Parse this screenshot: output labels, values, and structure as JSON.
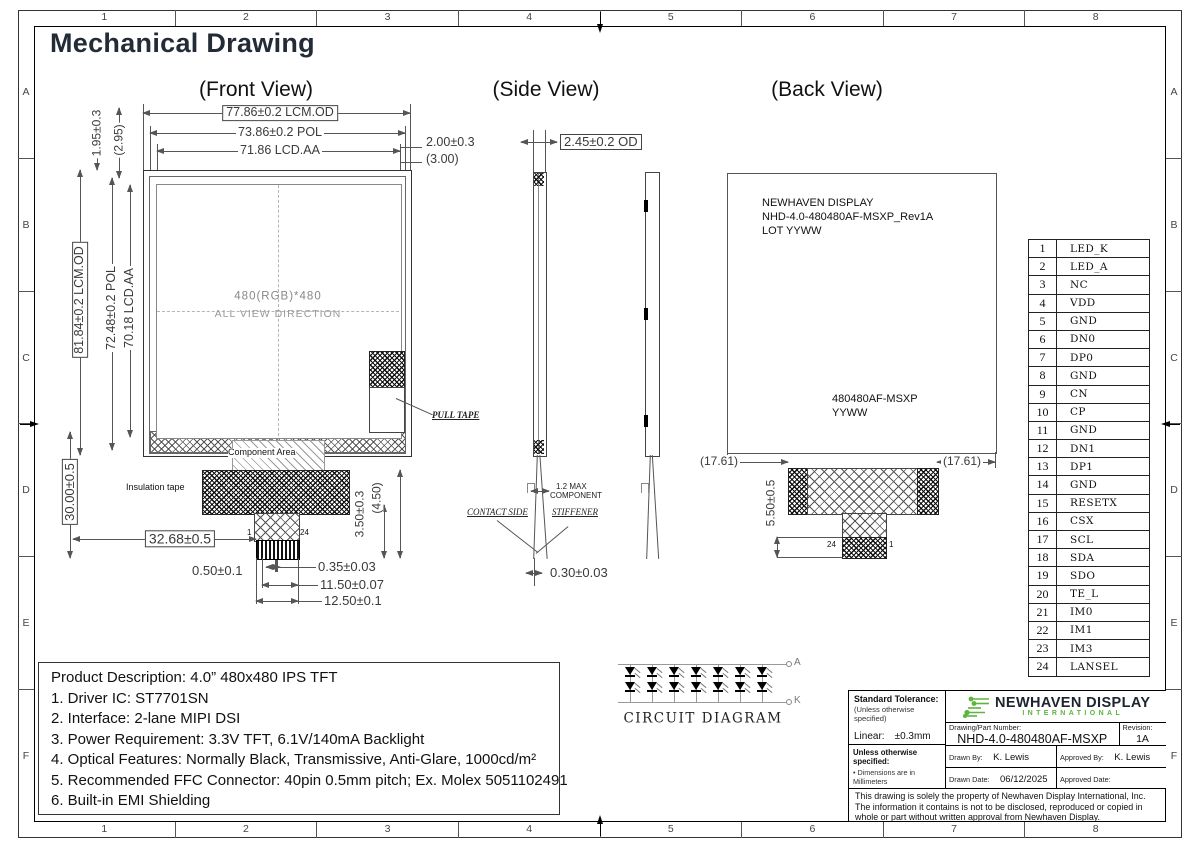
{
  "sheet": {
    "title": "Mechanical Drawing",
    "cols": [
      "1",
      "2",
      "3",
      "4",
      "5",
      "6",
      "7",
      "8"
    ],
    "rows": [
      "A",
      "B",
      "C",
      "D",
      "E",
      "F"
    ]
  },
  "views": {
    "front": {
      "label": "(Front View)",
      "dim_width_od": "77.86±0.2  LCM.OD",
      "dim_width_pol": "73.86±0.2  POL",
      "dim_width_aa": "71.86  LCD.AA",
      "dim_right_1": "2.00±0.3",
      "dim_right_2": "(3.00)",
      "dim_top_1": "1.95±0.3",
      "dim_top_2": "(2.95)",
      "dim_height_od": "81.84±0.2  LCM.OD",
      "dim_height_pol": "72.48±0.2  POL",
      "dim_height_aa": "70.18  LCD.AA",
      "dim_height_total": "30.00±0.5",
      "dim_fpc_offset": "32.68±0.5",
      "dim_pin_pitch": "0.50±0.1",
      "dim_pin_width": "0.35±0.03",
      "dim_pins_span": "11.50±0.07",
      "dim_fpc_width": "12.50±0.1",
      "dim_tail_1": "3.50±0.3",
      "dim_tail_2": "(4.50)",
      "aa_line1": "480(RGB)*480",
      "aa_line2": "ALL  VIEW  DIRECTION",
      "component_area": "Component Area",
      "insulation_tape": "Insulation tape",
      "bending_area": "Bending Area",
      "pull_tape": "PULL TAPE",
      "pin_first": "1",
      "pin_last": "24"
    },
    "side": {
      "label": "(Side View)",
      "dim_thickness": "2.45±0.2  OD",
      "component_note_1": "1.2  MAX",
      "component_note_2": "COMPONENT",
      "contact_side": "CONTACT SIDE",
      "stiffener": "STIFFENER",
      "dim_fpc_thickness": "0.30±0.03"
    },
    "back": {
      "label": "(Back View)",
      "marking_1a": "NEWHAVEN DISPLAY",
      "marking_1b": "NHD-4.0-480480AF-MSXP_Rev1A",
      "marking_1c": "LOT YYWW",
      "marking_2a": "480480AF-MSXP",
      "marking_2b": "YYWW",
      "dim_left": "(17.61)",
      "dim_right": "(17.61)",
      "dim_tail": "5.50±0.5",
      "pin_last": "24",
      "pin_first": "1"
    }
  },
  "pin_table": {
    "rows": [
      {
        "pin": "1",
        "name": "LED_K"
      },
      {
        "pin": "2",
        "name": "LED_A"
      },
      {
        "pin": "3",
        "name": "NC"
      },
      {
        "pin": "4",
        "name": "VDD"
      },
      {
        "pin": "5",
        "name": "GND"
      },
      {
        "pin": "6",
        "name": "DN0"
      },
      {
        "pin": "7",
        "name": "DP0"
      },
      {
        "pin": "8",
        "name": "GND"
      },
      {
        "pin": "9",
        "name": "CN"
      },
      {
        "pin": "10",
        "name": "CP"
      },
      {
        "pin": "11",
        "name": "GND"
      },
      {
        "pin": "12",
        "name": "DN1"
      },
      {
        "pin": "13",
        "name": "DP1"
      },
      {
        "pin": "14",
        "name": "GND"
      },
      {
        "pin": "15",
        "name": "RESETX"
      },
      {
        "pin": "16",
        "name": "CSX"
      },
      {
        "pin": "17",
        "name": "SCL"
      },
      {
        "pin": "18",
        "name": "SDA"
      },
      {
        "pin": "19",
        "name": "SDO"
      },
      {
        "pin": "20",
        "name": "TE_L"
      },
      {
        "pin": "21",
        "name": "IM0"
      },
      {
        "pin": "22",
        "name": "IM1"
      },
      {
        "pin": "23",
        "name": "IM3"
      },
      {
        "pin": "24",
        "name": "LANSEL"
      }
    ]
  },
  "description": {
    "lines": [
      "Product Description: 4.0” 480x480 IPS TFT",
      "1. Driver IC: ST7701SN",
      "2. Interface: 2-lane MIPI DSI",
      "3. Power Requirement: 3.3V TFT, 6.1V/140mA Backlight",
      "4. Optical Features: Normally Black, Transmissive, Anti-Glare, 1000cd/m²",
      "5. Recommended FFC Connector: 40pin 0.5mm pitch; Ex. Molex 5051102491",
      "6. Built-in EMI Shielding"
    ]
  },
  "circuit": {
    "label": "CIRCUIT DIAGRAM",
    "anode": "A",
    "cathode": "K",
    "columns": [
      "1",
      "2",
      "3",
      "4",
      "5",
      "6",
      "7"
    ]
  },
  "title_block": {
    "tolerance_title": "Standard Tolerance:",
    "tolerance_note": "(Unless otherwise specified)",
    "linear_label": "Linear:",
    "linear_value": "±0.3mm",
    "spec_title": "Unless otherwise specified:",
    "spec_item1": "• Dimensions are in Millimeters",
    "spec_item2": "• Third Angle Projection",
    "brand_name": "NEWHAVEN DISPLAY",
    "brand_sub": "INTERNATIONAL",
    "part_label": "Drawing/Part Number:",
    "part_number": "NHD-4.0-480480AF-MSXP",
    "revision_label": "Revision:",
    "revision": "1A",
    "drawn_by_label": "Drawn By:",
    "drawn_by": "K. Lewis",
    "approved_by_label": "Approved By:",
    "approved_by": "K. Lewis",
    "drawn_date_label": "Drawn Date:",
    "drawn_date": "06/12/2025",
    "approved_date_label": "Approved Date:",
    "approved_date": "06/12/2025",
    "disclaimer": "This drawing is solely the property of Newhaven Display International, Inc. The information it contains is not to be disclosed, reproduced or copied in whole or part without written approval from Newhaven Display."
  },
  "colors": {
    "brand_green": "#5cb53c",
    "title_dark": "#222b36"
  }
}
